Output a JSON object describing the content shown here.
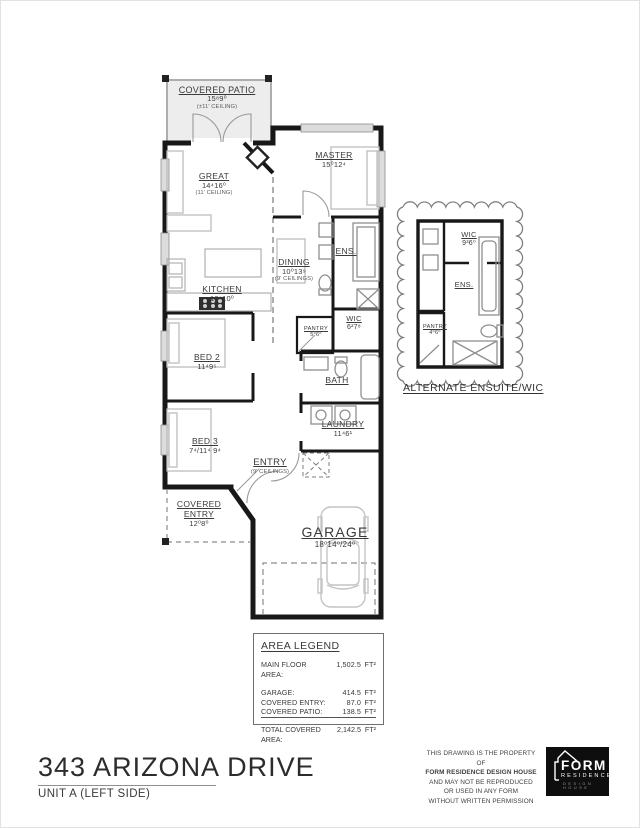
{
  "plan": {
    "rooms": [
      {
        "id": "covered-patio",
        "name": "COVERED PATIO",
        "dims": "15⁸9⁰",
        "note": "(±11' CEILING)"
      },
      {
        "id": "great",
        "name": "GREAT",
        "dims": "14⁴16⁰",
        "note": "(11' CEILING)"
      },
      {
        "id": "master",
        "name": "MASTER",
        "dims": "15⁰12⁴",
        "note": ""
      },
      {
        "id": "dining",
        "name": "DINING",
        "dims": "10⁰13⁹",
        "note": "(9' CEILINGS)"
      },
      {
        "id": "ens",
        "name": "ENS.",
        "dims": "",
        "note": ""
      },
      {
        "id": "kitchen",
        "name": "KITCHEN",
        "dims": "10⁸10⁰",
        "note": ""
      },
      {
        "id": "wic",
        "name": "WIC",
        "dims": "6²7⁸",
        "note": ""
      },
      {
        "id": "pantry",
        "name": "PANTRY",
        "dims": "5⁰6⁰",
        "note": ""
      },
      {
        "id": "bed2",
        "name": "BED 2",
        "dims": "11⁴9⁵",
        "note": ""
      },
      {
        "id": "bath",
        "name": "BATH",
        "dims": "",
        "note": ""
      },
      {
        "id": "bed3",
        "name": "BED 3",
        "dims": "7⁴/11⁴ 9⁴",
        "note": ""
      },
      {
        "id": "laundry",
        "name": "LAUNDRY",
        "dims": "11⁴6¹",
        "note": ""
      },
      {
        "id": "entry",
        "name": "ENTRY",
        "dims": "",
        "note": "(9' CEILINGS)"
      },
      {
        "id": "covered-entry",
        "name": "COVERED ENTRY",
        "dims": "12⁰8⁰",
        "note": ""
      },
      {
        "id": "garage",
        "name": "GARAGE",
        "dims": "18⁰14⁰/24⁰",
        "note": ""
      }
    ]
  },
  "alternate": {
    "caption": "ALTERNATE ENSUITE/WIC",
    "rooms": [
      {
        "id": "alt-wic",
        "name": "WIC",
        "dims": "9³6⁰"
      },
      {
        "id": "alt-ens",
        "name": "ENS.",
        "dims": ""
      },
      {
        "id": "alt-pantry",
        "name": "PANTRY",
        "dims": "4⁰6⁰"
      }
    ]
  },
  "area_legend": {
    "title": "AREA LEGEND",
    "rows": [
      {
        "label": "MAIN FLOOR AREA:",
        "value": "1,502.5",
        "unit": "FT²"
      },
      {
        "label": "GARAGE:",
        "value": "414.5",
        "unit": "FT²"
      },
      {
        "label": "COVERED ENTRY:",
        "value": "87.0",
        "unit": "FT²"
      },
      {
        "label": "COVERED PATIO:",
        "value": "138.5",
        "unit": "FT²"
      }
    ],
    "total": {
      "label": "TOTAL COVERED AREA:",
      "value": "2,142.5",
      "unit": "FT²"
    }
  },
  "title_block": {
    "title": "343 ARIZONA DRIVE",
    "subtitle": "UNIT A (LEFT SIDE)"
  },
  "copyright": {
    "line1": "THIS DRAWING IS THE PROPERTY OF",
    "line2": "FORM RESIDENCE DESIGN HOUSE",
    "line3": "AND MAY NOT BE REPRODUCED",
    "line4": "OR USED IN ANY FORM",
    "line5": "WITHOUT WRITTEN PERMISSION"
  },
  "logo": {
    "name": "FORM",
    "line2": "RESIDENCE",
    "line3": "DESIGN HOUSE"
  },
  "colors": {
    "wall": "#181818",
    "fixture": "#b9b9b9",
    "dashed": "#8c8c8c",
    "patio_fill": "#ededed",
    "text": "#3a3a3a"
  }
}
